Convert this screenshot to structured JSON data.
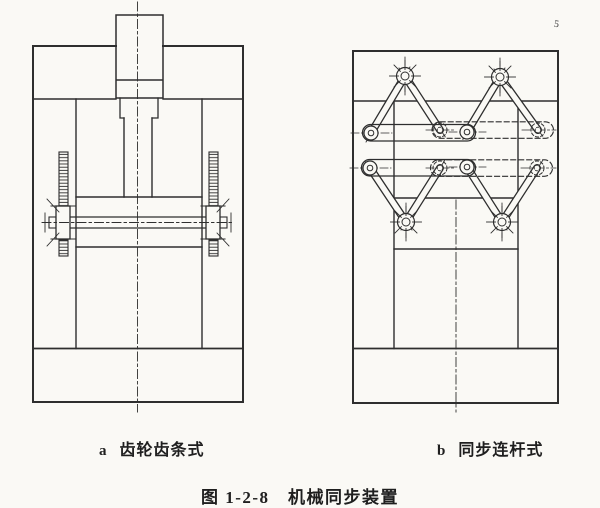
{
  "page": {
    "paper_color": "#faf9f5",
    "ink_color": "#2e2e2e"
  },
  "figure_a": {
    "marker": "a",
    "label": "齿轮齿条式"
  },
  "figure_b": {
    "marker": "b",
    "label": "同步连杆式"
  },
  "caption": "图 1-2-8　机械同步装置",
  "artifact_mark": "5"
}
